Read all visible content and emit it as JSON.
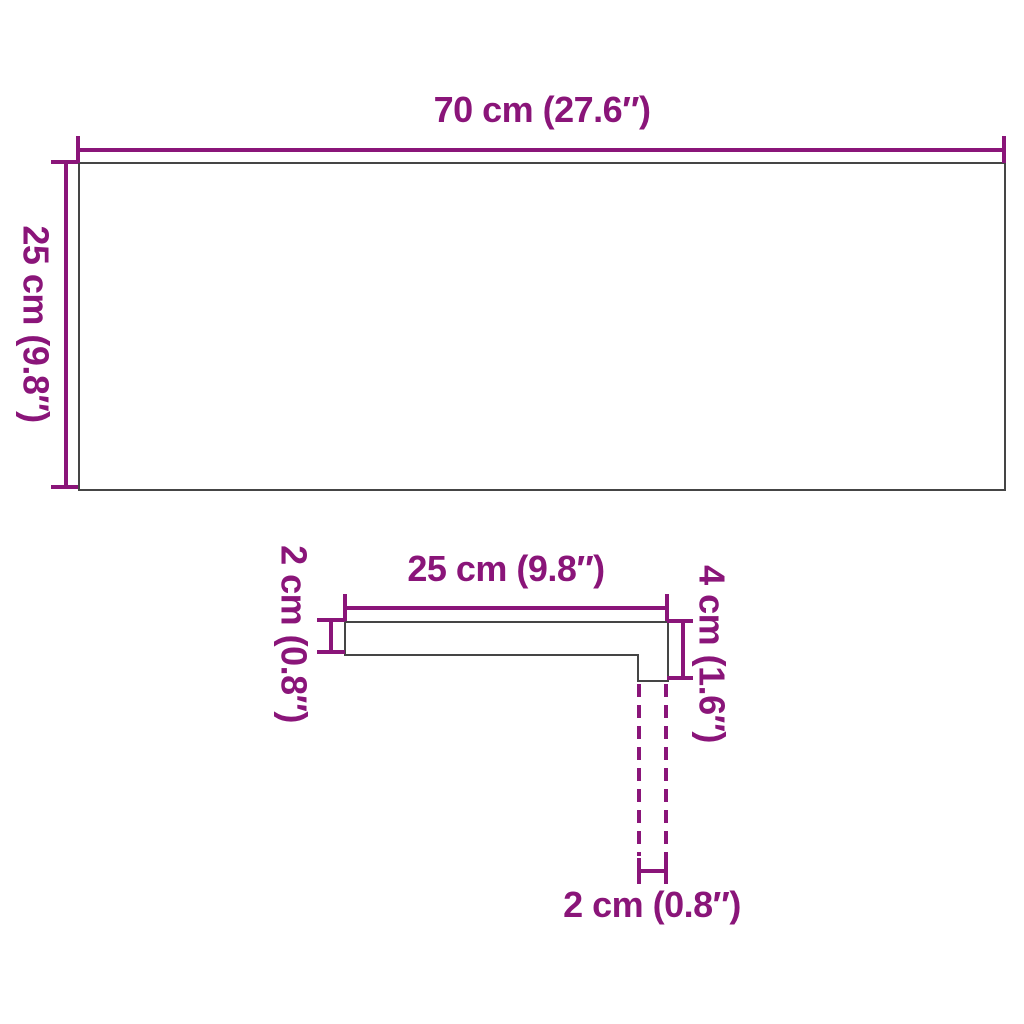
{
  "colors": {
    "accent": "#8A1579",
    "outline": "#454545",
    "background": "#FFFFFF"
  },
  "top_view": {
    "width_label": "70 cm (27.6″)",
    "height_label": "25 cm (9.8″)"
  },
  "profile_view": {
    "width_label": "25 cm (9.8″)",
    "thickness_label": "2 cm (0.8″)",
    "height_label": "4 cm (1.6″)",
    "lip_width_label": "2 cm (0.8″)"
  }
}
